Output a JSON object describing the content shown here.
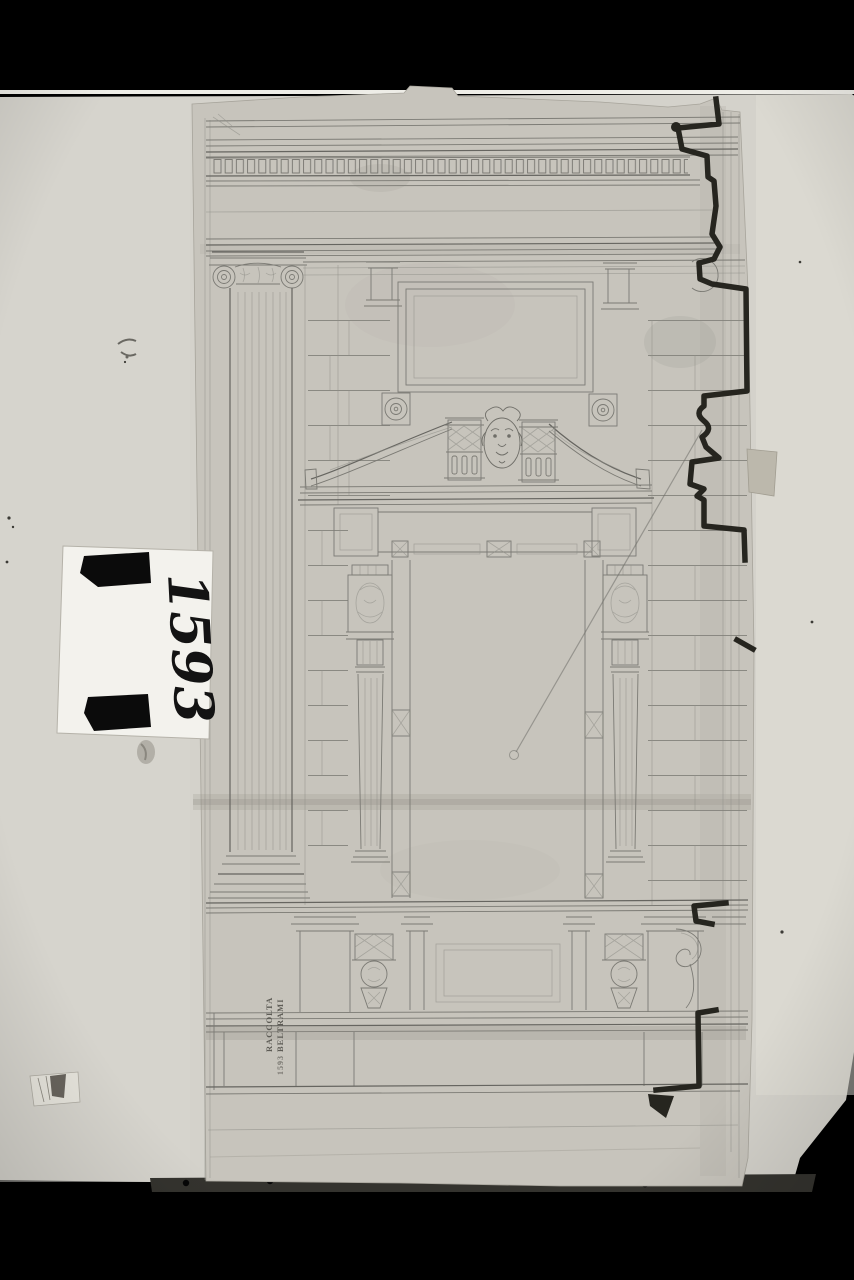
{
  "photo": {
    "type": "archival photograph of an architectural drawing",
    "colors": {
      "background": "#000000",
      "backing_paper": "#d4d2cb",
      "drawing_sheet": "#c7c4bc",
      "pencil": "#7b7a74",
      "ink_profile": "#26251f",
      "label_card": "#f3f2ed",
      "tape": "#0b0b0b"
    }
  },
  "inventory_label": {
    "number": "1593"
  },
  "collection_stamp": {
    "line1": "RACCOLTA",
    "line2": "BELTRAMI",
    "number": "1593"
  },
  "drawing": {
    "subject": "Elevation of a classical portal: Ionic column, rusticated wall, curved broken pediment with lion mask, herm pilasters, podium with corbels and scroll"
  }
}
